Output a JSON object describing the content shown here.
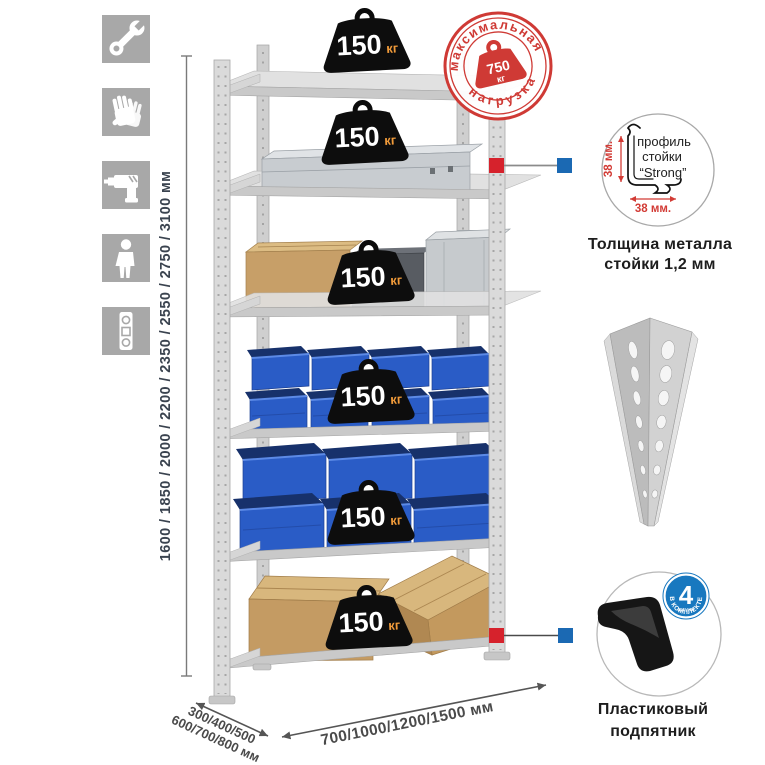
{
  "colors": {
    "accent_red": "#cf3a35",
    "accent_blue": "#1878bf",
    "icon_gray": "#a8a8a8",
    "metal_gray": "#dadada",
    "bin_blue": "#2a5cc6",
    "cardboard": "#c49b63",
    "badge_black": "#0d0d0d",
    "kg_orange": "#f19b3a"
  },
  "assembly_icons": [
    {
      "name": "wrench-icon"
    },
    {
      "name": "gloves-icon"
    },
    {
      "name": "drill-icon"
    },
    {
      "name": "person-icon"
    },
    {
      "name": "level-icon"
    }
  ],
  "dimensions": {
    "height": "1600 / 1850 / 2000 / 2200 / 2350 / 2550 / 2750 / 3100 мм",
    "depth_line1": "300/400/500",
    "depth_line2": "600/700/800 мм",
    "width": "700/1000/1200/1500 мм"
  },
  "shelf_badges": [
    {
      "value": "150",
      "unit": "кг"
    },
    {
      "value": "150",
      "unit": "кг"
    },
    {
      "value": "150",
      "unit": "кг"
    },
    {
      "value": "150",
      "unit": "кг"
    },
    {
      "value": "150",
      "unit": "кг"
    },
    {
      "value": "150",
      "unit": "кг"
    }
  ],
  "stamp": {
    "arc_top": "максимальная",
    "arc_bottom": "нагрузка",
    "value": "750",
    "unit": "кг"
  },
  "profile_callout": {
    "label_line1": "профиль",
    "label_line2": "стойки",
    "label_line3": "“Strong”",
    "dim_vertical": "38 мм.",
    "dim_horizontal": "38 мм.",
    "caption_line1": "Толщина металла",
    "caption_line2": "стойки 1,2 мм"
  },
  "foot_callout": {
    "badge_value": "4",
    "badge_word": "штуки",
    "badge_arc": "в комплекте",
    "caption_line1": "Пластиковый",
    "caption_line2": "подпятник"
  },
  "rack": {
    "shelf_count": 6,
    "shelf_contents": [
      "empty",
      "aluminium-case",
      "boxes-and-cases",
      "small-blue-bins",
      "large-blue-bins",
      "cardboard-boxes"
    ]
  }
}
